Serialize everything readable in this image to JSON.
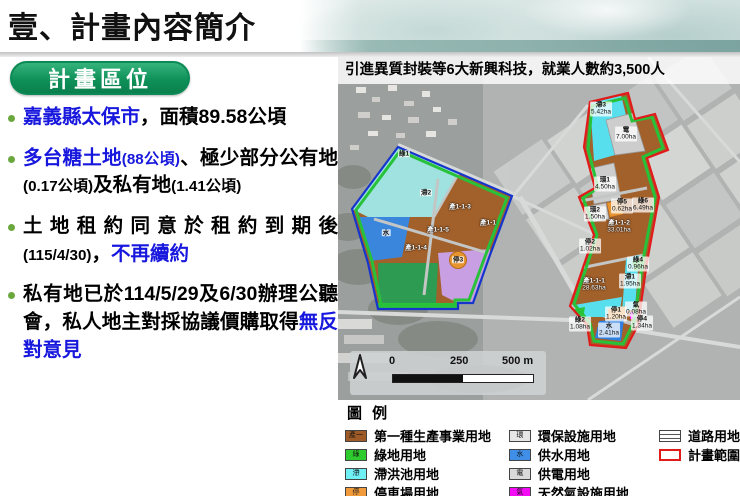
{
  "title": "壹、計畫內容簡介",
  "section_badge": "計畫區位",
  "bullets": [
    {
      "segments": [
        {
          "t": "嘉義縣太保市",
          "s": "blue"
        },
        {
          "t": "，面積89.58公頃",
          "s": ""
        }
      ]
    },
    {
      "segments": [
        {
          "t": "多台糖土地",
          "s": "blue"
        },
        {
          "t": "(88公頃)",
          "s": "blue small"
        },
        {
          "t": "、極少部分公有地",
          "s": ""
        },
        {
          "t": "(0.17公頃)",
          "s": "small"
        },
        {
          "t": "及私有地",
          "s": ""
        },
        {
          "t": "(1.41公頃)",
          "s": "small"
        }
      ]
    },
    {
      "segments": [
        {
          "t": "土地租約同意於租約到期後",
          "s": ""
        },
        {
          "t": "(115/4/30)",
          "s": "small"
        },
        {
          "t": "，",
          "s": ""
        },
        {
          "t": "不再續約",
          "s": "blue"
        }
      ]
    },
    {
      "segments": [
        {
          "t": "私有地已於114/5/29及6/30辦理公聽會，私人地主對採協議價購取得",
          "s": ""
        },
        {
          "t": "無反對意見",
          "s": "blue"
        }
      ]
    }
  ],
  "map": {
    "header": "引進異質封裝等6大新興科技，就業人數約3,500人",
    "scalebar": {
      "t0": "0",
      "t1": "250",
      "t2": "500 m"
    },
    "labels": [
      {
        "code": "滯3",
        "area": "5.42ha",
        "x": 263,
        "y": 52
      },
      {
        "code": "電",
        "area": "7.00ha",
        "x": 288,
        "y": 77
      },
      {
        "code": "環1",
        "area": "4.50ha",
        "x": 267,
        "y": 127
      },
      {
        "code": "環2",
        "area": "1.50ha",
        "x": 257,
        "y": 157
      },
      {
        "code": "停5",
        "area": "0.62ha",
        "x": 284,
        "y": 149
      },
      {
        "code": "綠6",
        "area": "6.49ha",
        "x": 305,
        "y": 148
      },
      {
        "code": "產1-1-2",
        "area": "33.01ha",
        "x": 281,
        "y": 170,
        "light": true
      },
      {
        "code": "停2",
        "area": "1.02ha",
        "x": 252,
        "y": 189
      },
      {
        "code": "綠4",
        "area": "0.96ha",
        "x": 300,
        "y": 207
      },
      {
        "code": "產1-1-1",
        "area": "28.63ha",
        "x": 256,
        "y": 228,
        "light": true
      },
      {
        "code": "滯1",
        "area": "1.95ha",
        "x": 292,
        "y": 224
      },
      {
        "code": "停1",
        "area": "1.20ha",
        "x": 278,
        "y": 257
      },
      {
        "code": "水",
        "area": "2.41ha",
        "x": 271,
        "y": 273
      },
      {
        "code": "氣",
        "area": "0.08ha",
        "x": 298,
        "y": 252
      },
      {
        "code": "停4",
        "area": "1.34ha",
        "x": 304,
        "y": 266
      },
      {
        "code": "綠2",
        "area": "1.08ha",
        "x": 242,
        "y": 267
      },
      {
        "code": "綠1",
        "x": 66,
        "y": 97
      },
      {
        "code": "滯2",
        "x": 88,
        "y": 136
      },
      {
        "code": "水",
        "x": 48,
        "y": 176
      },
      {
        "code": "產1-1-3",
        "x": 122,
        "y": 150,
        "light": true
      },
      {
        "code": "產1-1-5",
        "x": 100,
        "y": 173,
        "light": true
      },
      {
        "code": "產1-1-4",
        "x": 78,
        "y": 191,
        "light": true
      },
      {
        "code": "產1-1",
        "x": 150,
        "y": 166,
        "light": true
      },
      {
        "code": "停3",
        "x": 120,
        "y": 203
      }
    ]
  },
  "legend": {
    "title": "圖 例",
    "columns": [
      [
        {
          "char": "產一",
          "color": "#9e5b28",
          "label": "第一種生產事業用地"
        },
        {
          "char": "綠",
          "color": "#2ecc2e",
          "label": "綠地用地"
        },
        {
          "char": "滯",
          "color": "#6ff0f5",
          "label": "滯洪池用地"
        },
        {
          "char": "停",
          "color": "#f09a3c",
          "label": "停車場用地"
        }
      ],
      [
        {
          "char": "環",
          "color": "#e6e6e6",
          "label": "環保設施用地"
        },
        {
          "char": "水",
          "color": "#3f8fe8",
          "label": "供水用地"
        },
        {
          "char": "電",
          "color": "#dadada",
          "label": "供電用地"
        },
        {
          "char": "氣",
          "color": "#f50af5",
          "label": "天然氣設施用地"
        }
      ],
      [
        {
          "type": "road",
          "label": "道路用地"
        },
        {
          "type": "boundary",
          "label": "計畫範圍"
        }
      ]
    ]
  },
  "colors": {
    "badge_green": "#0f9159",
    "bullet_blue": "#1717dd",
    "plan_boundary_red": "#e11a1a",
    "left_boundary_blue": "#1535cd",
    "zone_inner_green": "#27c23a",
    "parcel_brown": "#a2602a",
    "detention_cyan": "#58dfee",
    "water_blue": "#2f7fe0",
    "parking_orange": "#e8942e",
    "gas_magenta": "#f512f5"
  }
}
